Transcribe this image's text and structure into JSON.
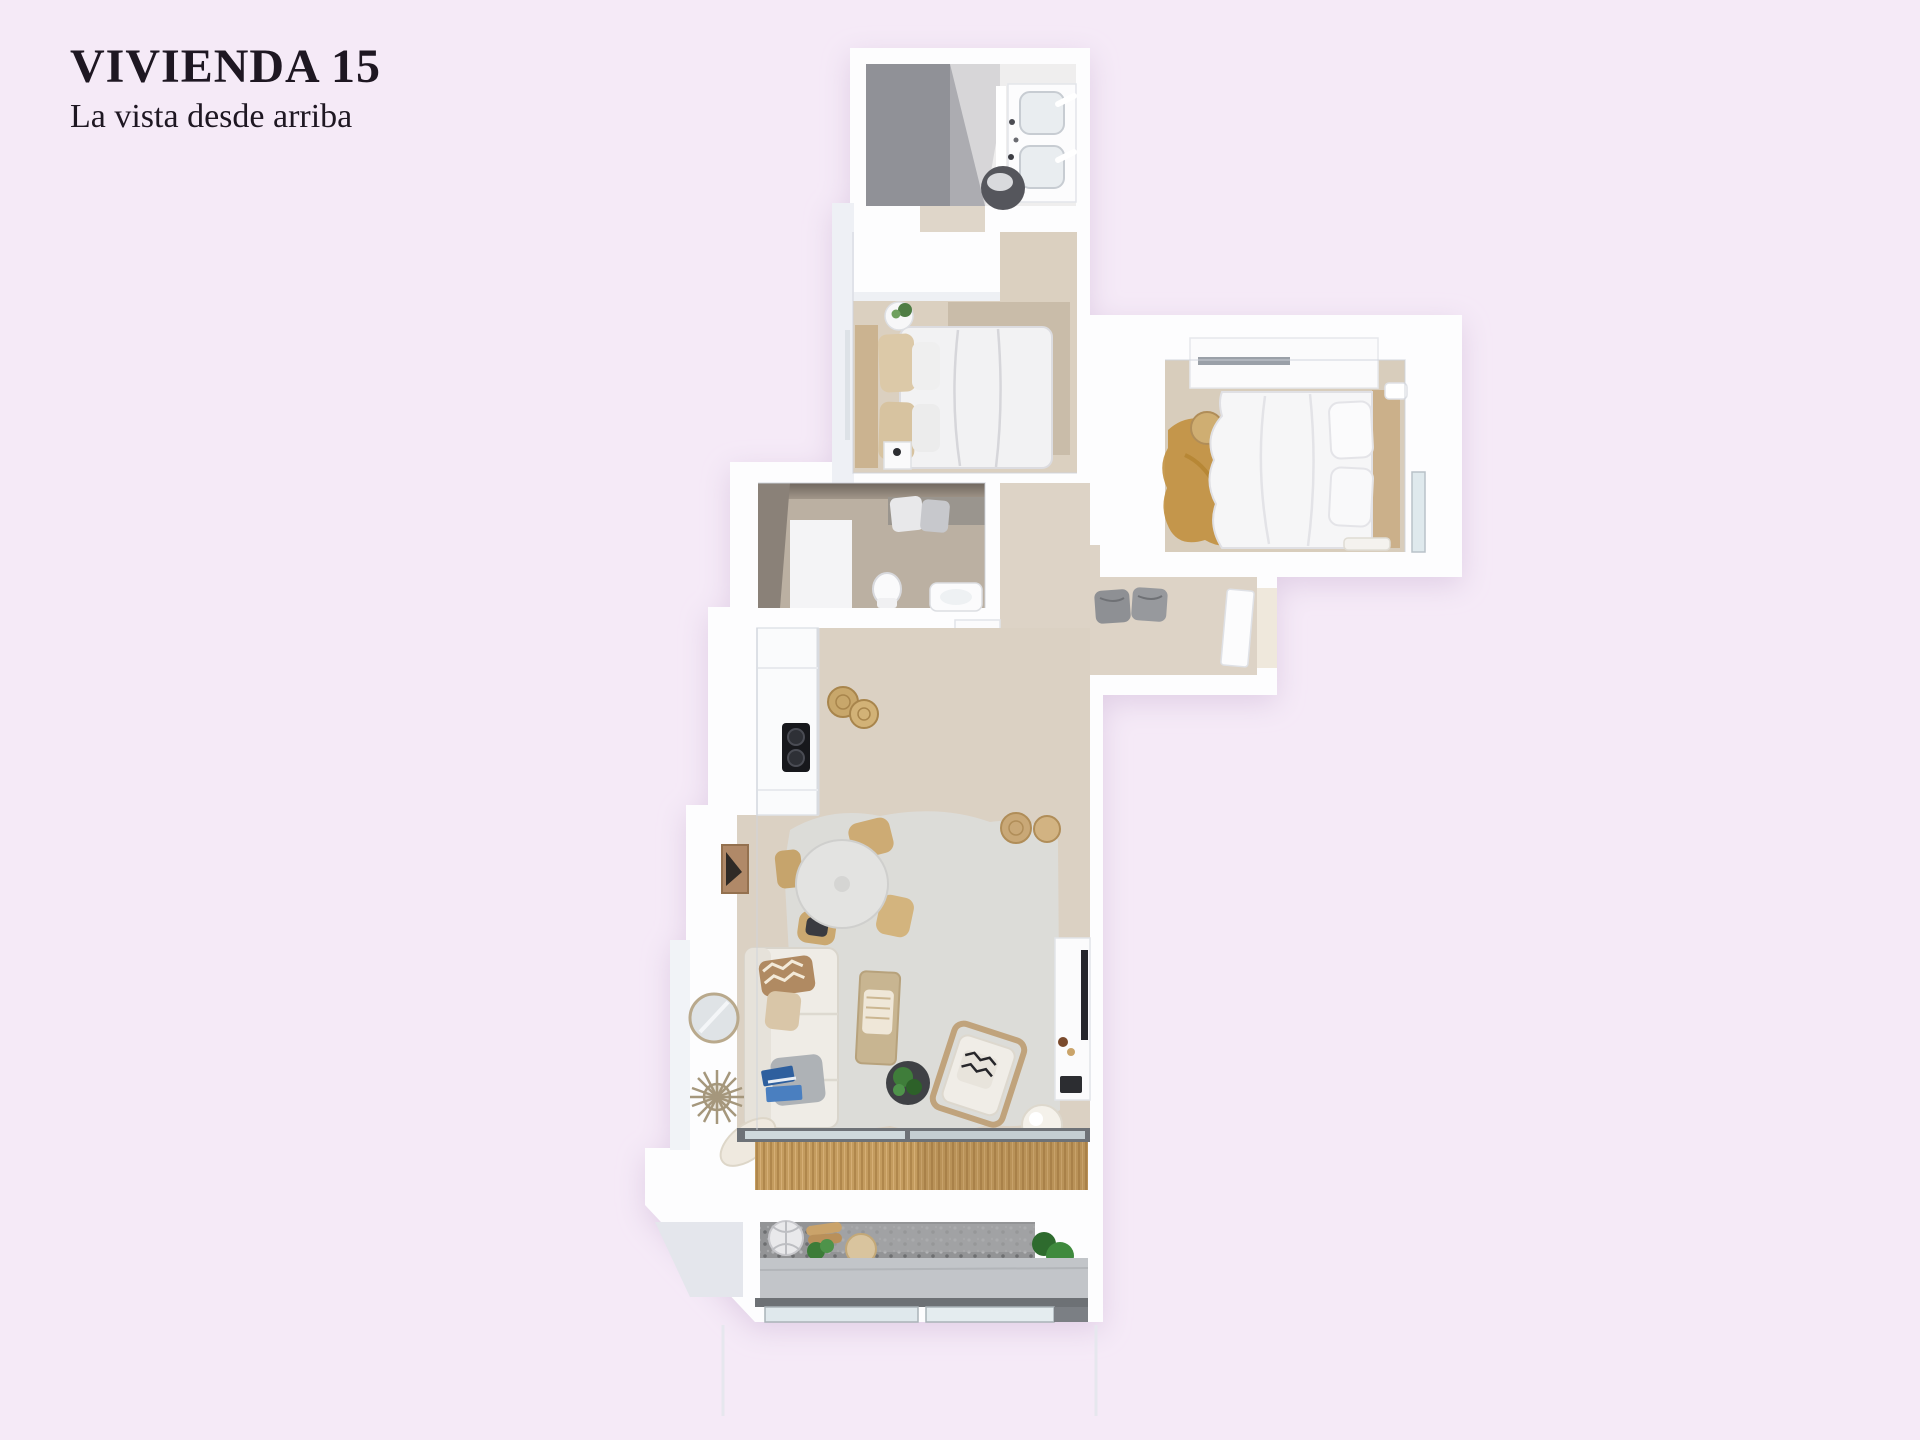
{
  "page": {
    "background_color": "#f5eaf7",
    "text_color": "#1e1722"
  },
  "header": {
    "title": "VIVIENDA 15",
    "subtitle": "La vista desde arriba"
  },
  "floorplan": {
    "kind": "3d-top-down-apartment-render",
    "palette": {
      "wall_white": "#fdfdfe",
      "wall_shade": "#e9ecf1",
      "floor_beige": "#dbd1c3",
      "bathroom_taupe_dark": "#79716",
      " ": "",
      "bathroom_taupe_floor": "#bbb0a2",
      "shower_gray": "#909197",
      "rug_gray": "#dcdcda",
      "rug_gold": "#c2903e",
      "bamboo_mat": "#c49c5f",
      "gravel_gray": "#939496",
      "walkway_gray": "#c2c5c8",
      "glass_blue": "#dce7eb",
      "plant_green": "#3f7d3a",
      "wood_tan": "#c8a76b",
      "furniture_black": "#3a3b40"
    },
    "rooms": [
      "bathroom-top",
      "bedroom-1",
      "bedroom-2",
      "bathroom-2",
      "hallway-entry",
      "kitchen",
      "dining-area",
      "living-room",
      "terrace"
    ]
  }
}
